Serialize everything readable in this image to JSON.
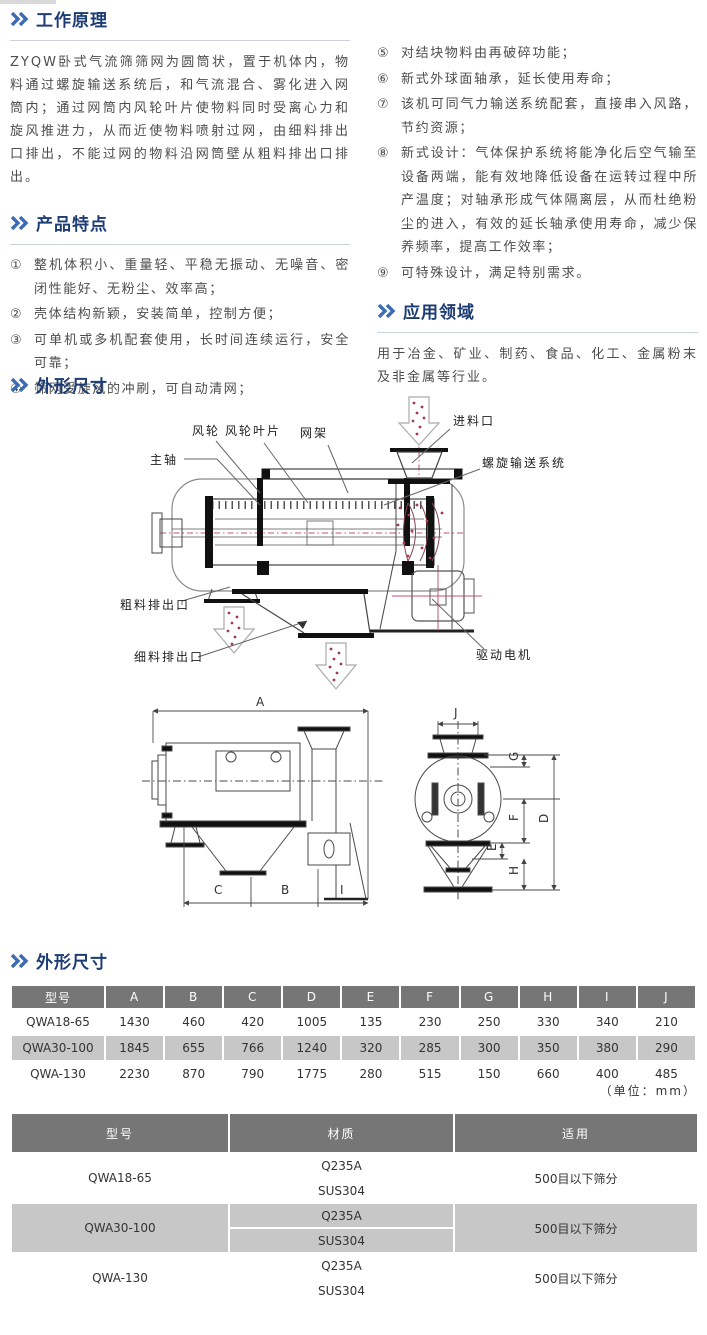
{
  "colors": {
    "heading": "#1d3c74",
    "chevron": "#3c6cb5",
    "underline": "#c9d2dd",
    "table_header_bg": "#767676",
    "table_header_text": "#ffffff",
    "row_alt_bg": "#c7c7c7",
    "body_text": "#4d4d4d",
    "diagram_red": "#b43a57"
  },
  "working_principle": {
    "title": "工作原理",
    "body": "ZYQW卧式气流筛筛网为圆筒状，置于机体内，物料通过螺旋输送系统后，和气流混合、雾化进入网筒内；通过网筒内风轮叶片使物料同时受离心力和旋风推进力，从而近使物料喷射过网，由细料排出口排出，不能过网的物料沿网筒壁从粗料排出口排出。"
  },
  "features": {
    "title": "产品特点",
    "left_items": [
      {
        "num": "①",
        "text": "整机体积小、重量轻、平稳无振动、无噪音、密闭性能好、无粉尘、效率高；"
      },
      {
        "num": "②",
        "text": "壳体结构新颖，安装简单，控制方便；"
      },
      {
        "num": "③",
        "text": "可单机或多机配套使用，长时间连续运行，安全可靠；"
      },
      {
        "num": "④",
        "text": "筛网受旋风的冲刷，可自动清网；"
      }
    ],
    "right_items": [
      {
        "num": "⑤",
        "text": "对结块物料由再破碎功能；"
      },
      {
        "num": "⑥",
        "text": "新式外球面轴承，延长使用寿命；"
      },
      {
        "num": "⑦",
        "text": "该机可同气力输送系统配套，直接串入风路，节约资源；"
      },
      {
        "num": "⑧",
        "text": "新式设计：气体保护系统将能净化后空气输至设备两端，能有效地降低设备在运转过程中所产温度；对轴承形成气体隔离层，从而杜绝粉尘的进入，有效的延长轴承使用寿命，减少保养频率，提高工作效率；"
      },
      {
        "num": "⑨",
        "text": "可特殊设计，满足特别需求。"
      }
    ]
  },
  "application": {
    "title": "应用领域",
    "body": "用于冶金、矿业、制药、食品、化工、金属粉末及非金属等行业。"
  },
  "outline_figure": {
    "title": "外形尺寸",
    "labels": {
      "main_shaft": "主轴",
      "wind_wheel": "风轮",
      "wind_blade": "风轮叶片",
      "mesh_frame": "网架",
      "feed_inlet": "进料口",
      "screw_system": "螺旋输送系统",
      "coarse_outlet": "粗料排出口",
      "fine_outlet": "细料排出口",
      "drive_motor": "驱动电机"
    },
    "dims": {
      "A": "A",
      "B": "B",
      "C": "C",
      "D": "D",
      "E": "E",
      "F": "F",
      "G": "G",
      "H": "H",
      "I": "I",
      "J": "J"
    }
  },
  "dimension_table": {
    "title": "外形尺寸",
    "unit_note": "（单位：mm）",
    "headers": [
      "型号",
      "A",
      "B",
      "C",
      "D",
      "E",
      "F",
      "G",
      "H",
      "I",
      "J"
    ],
    "rows": [
      {
        "model": "QWA18-65",
        "values": [
          "1430",
          "460",
          "420",
          "1005",
          "135",
          "230",
          "250",
          "330",
          "340",
          "210"
        ]
      },
      {
        "model": "QWA30-100",
        "values": [
          "1845",
          "655",
          "766",
          "1240",
          "320",
          "285",
          "300",
          "350",
          "380",
          "290"
        ]
      },
      {
        "model": "QWA-130",
        "values": [
          "2230",
          "870",
          "790",
          "1775",
          "280",
          "515",
          "150",
          "660",
          "400",
          "485"
        ]
      }
    ]
  },
  "material_table": {
    "headers": [
      "型号",
      "材质",
      "适用"
    ],
    "rows": [
      {
        "model": "QWA18-65",
        "materials": [
          "Q235A",
          "SUS304"
        ],
        "usage": "500目以下筛分"
      },
      {
        "model": "QWA30-100",
        "materials": [
          "Q235A",
          "SUS304"
        ],
        "usage": "500目以下筛分"
      },
      {
        "model": "QWA-130",
        "materials": [
          "Q235A",
          "SUS304"
        ],
        "usage": "500目以下筛分"
      }
    ]
  }
}
